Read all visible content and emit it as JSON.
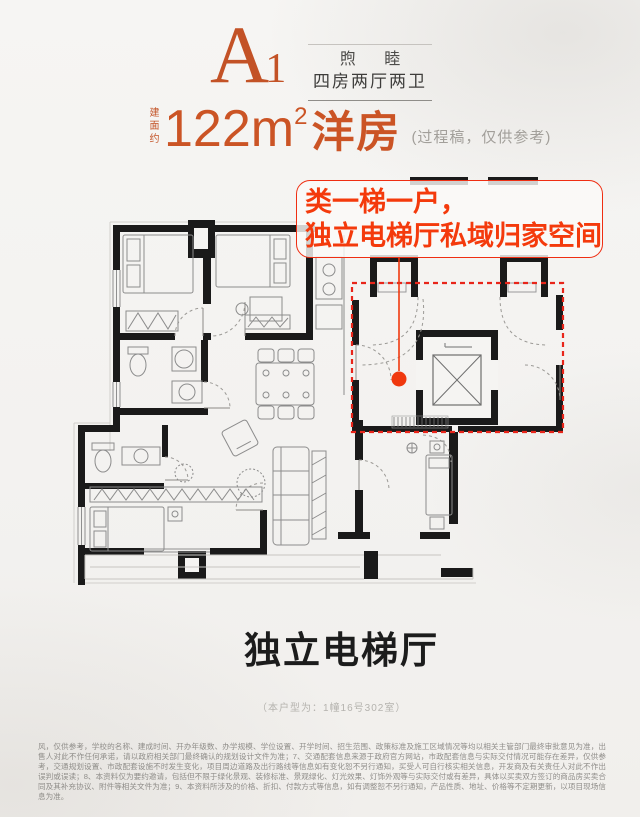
{
  "header": {
    "unit_code": "A",
    "unit_code_sub": "1",
    "series_name": "煦 睦",
    "layout_desc": "四房两厅两卫"
  },
  "area": {
    "prefix_vertical": "建面约",
    "size_value": "122m",
    "size_sup": "2",
    "size_type": "洋房",
    "note": "(过程稿，仅供参考)"
  },
  "callout": {
    "line1": "类一梯一户，",
    "line2": "独立电梯厅私域归家空间"
  },
  "plan": {
    "highlight_color": "#e8251a",
    "marker_color": "#f0380e",
    "wall_color": "#1a1a1a",
    "accent_orange": "#c35226"
  },
  "bottom": {
    "headline": "独立电梯厅",
    "caption": "（本户型为：1幢16号302室）",
    "disclaimer": "风，仅供参考，学校的名称、建成时间、开办年级数、办学规模、学位设置、开学时间、招生范围、政策标准及施工区域情况等均以相关主管部门最终审批意见为准，出售人对此不作任何承诺，请以政府相关部门最终确认的规划设计文件为准；7、交通配套信息来源于政府官方网站，市政配套信息与实际交付情况可能存在差异，仅供参考，交通规划设置、市政配套设施不时发生变化，项目周边道路及出行路线等信息如有变化恕不另行通知，买受人可自行核实相关信息，开发商及有关责任人对此不作出误判或误读；8、本资料仅为要约邀请，包括但不限于绿化景观、装修标准、景观绿化、灯光效果、灯饰外观等与实际交付或有差异，具体以买卖双方签订的商品房买卖合同及其补充协议、附件等相关文件为准；9、本资料所涉及的价格、折扣、付款方式等信息，如有调整恕不另行通知，产品性质、地址、价格等不定期更新，以项目现场信息为准。"
  }
}
